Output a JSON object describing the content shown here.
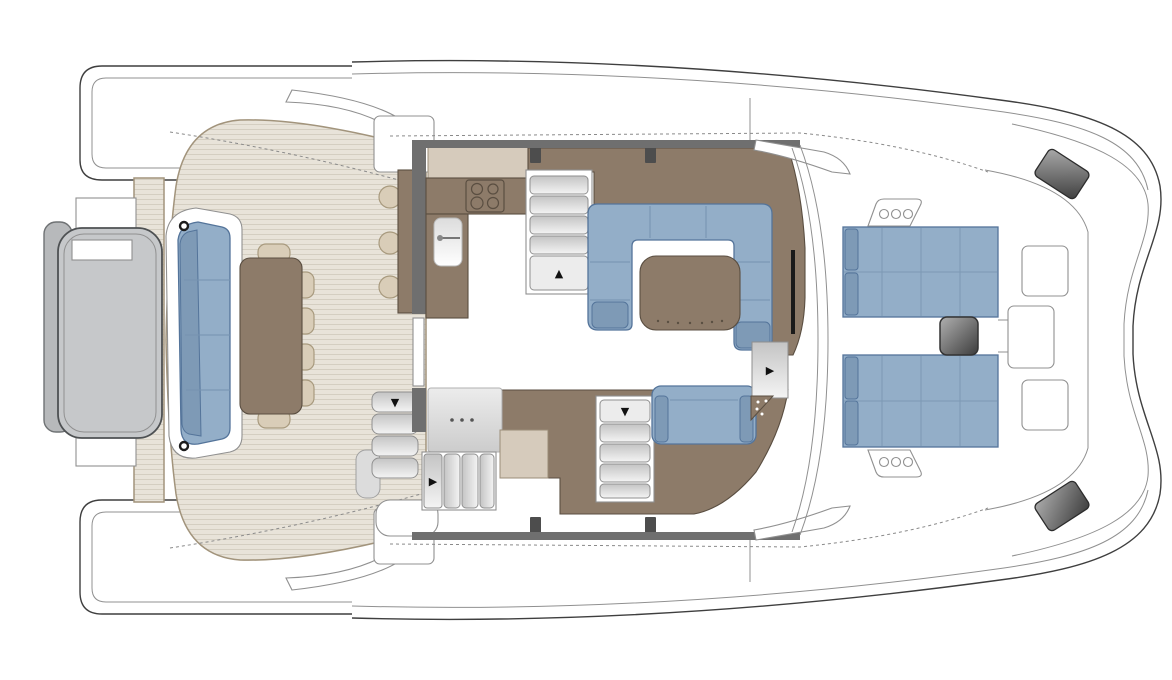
{
  "palette": {
    "white": "#ffffff",
    "hullLine": "#3f3f3f",
    "hullLineLight": "#909090",
    "dashGray": "#8a8a8a",
    "teak": "#e8e3d9",
    "teakStripe": "#d4cec1",
    "teakBorder": "#a2947c",
    "platformGray": "#c6c8ca",
    "platformBorder": "#4e5153",
    "platformStrip": "#b7b9bb",
    "platformStripBorder": "#6f7274",
    "brown": "#8d7b69",
    "brownBorder": "#5a4e41",
    "beigeCounter": "#d6cbbc",
    "beigeBorder": "#9b8e79",
    "blue": "#93aec8",
    "blueBorder": "#54749a",
    "blueDark": "#7e9ab6",
    "blueSeam": "#7693b0",
    "sunpadGrid": "#7c98b4",
    "chairBeige": "#d9cdb8",
    "chairBorder": "#a89a7e",
    "stepBorder": "#8f8f8f",
    "stepLight": "#f4f4f4",
    "stepDark": "#c4c4c4",
    "windowGray": "#6f6f6f",
    "darkPost": "#4d4d4d",
    "trackBlack": "#1a1a1a",
    "cleatDark": "#3e3e3e",
    "cleatLight": "#ababab",
    "sinkLight": "#ffffff",
    "sinkDark": "#dcdcdc",
    "consoleLight": "#ececec",
    "consoleDark": "#cccccc",
    "ftLight": "#b0b0b0",
    "ftDark": "#3c3c3c",
    "arrow": "#111111",
    "dotGray": "#555555"
  },
  "icons": {
    "arrow_up": "▲",
    "arrow_down": "▼",
    "arrow_right": "▶"
  },
  "plan": {
    "type": "catamaran-main-deck-floor-plan",
    "view": "top-down-bow-right",
    "aft_deck": {
      "dining_chairs": 6,
      "bar_stools": 3,
      "transom_sofa_sections": 4,
      "flybridge_stair_treads": 4
    },
    "galley": {
      "cooktop_burners": 4,
      "sinks": 1
    },
    "stairways": 4,
    "salon": {
      "settee_shape": "U",
      "tables": 1
    },
    "helm": {
      "bench_seats": 1
    },
    "foredeck": {
      "sunpads": 2,
      "sunpad_sections_each": 8,
      "center_tables": 1,
      "bow_seats": 3,
      "portlights_per_side": 3,
      "bow_cleats": 2
    }
  }
}
